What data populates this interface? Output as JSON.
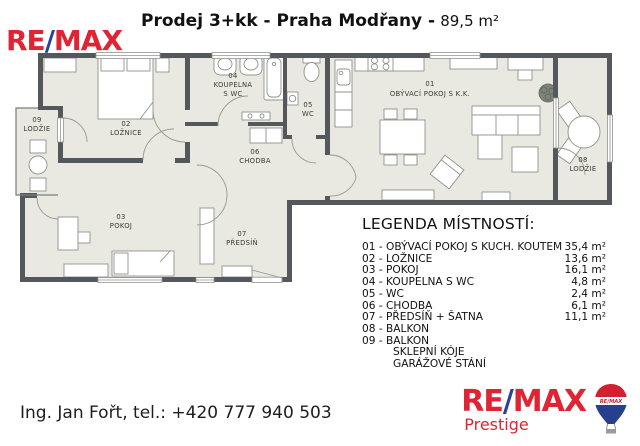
{
  "header": {
    "title": "Prodej 3+kk - Praha Modřany -",
    "area": "89,5 m²"
  },
  "brand": {
    "re": "RE",
    "slash": "/",
    "max": "MAX",
    "prestige": "Prestige",
    "balloon_label": "RE/MAX"
  },
  "colors": {
    "remax_red": "#df2433",
    "remax_blue": "#2a4496",
    "wall": "#54585c",
    "floor": "#e9e8e1"
  },
  "floorplan": {
    "rooms": {
      "r01": {
        "num": "01",
        "name": "OBÝVACÍ POKOJ S K.K."
      },
      "r02": {
        "num": "02",
        "name": "LOŽNICE"
      },
      "r03": {
        "num": "03",
        "name": "POKOJ"
      },
      "r04": {
        "num": "04",
        "name": "KOUPELNA",
        "name2": "S WC"
      },
      "r05": {
        "num": "05",
        "name": "WC"
      },
      "r06": {
        "num": "06",
        "name": "CHODBA"
      },
      "r07": {
        "num": "07",
        "name": "PŘEDSÍŇ"
      },
      "r08": {
        "num": "08",
        "name": "LODŽIE"
      },
      "r09": {
        "num": "09",
        "name": "LODŽIE"
      }
    }
  },
  "legend": {
    "title": "LEGENDA MÍSTNOSTÍ:",
    "items": [
      {
        "label": "01 - OBÝVACÍ POKOJ S KUCH. KOUTEM",
        "area": "35,4 m²",
        "indent": false
      },
      {
        "label": "02 - LOŽNICE",
        "area": "13,6 m²",
        "indent": false
      },
      {
        "label": "03 - POKOJ",
        "area": "16,1 m²",
        "indent": false
      },
      {
        "label": "04 - KOUPELNA S WC",
        "area": "4,8 m²",
        "indent": false
      },
      {
        "label": "05 - WC",
        "area": "2,4 m²",
        "indent": false
      },
      {
        "label": "06 - CHODBA",
        "area": "6,1 m²",
        "indent": false
      },
      {
        "label": "07 - PŘEDSÍŇ + ŠATNA",
        "area": "11,1 m²",
        "indent": false
      },
      {
        "label": "08 - BALKON",
        "area": "",
        "indent": false
      },
      {
        "label": "09 - BALKON",
        "area": "",
        "indent": false
      },
      {
        "label": "SKLEPNÍ KÓJE",
        "area": "",
        "indent": true
      },
      {
        "label": "GARÁŽOVÉ STÁNÍ",
        "area": "",
        "indent": true
      }
    ]
  },
  "footer": {
    "contact": "Ing. Jan Fořt, tel.: +420 777 940 503"
  }
}
